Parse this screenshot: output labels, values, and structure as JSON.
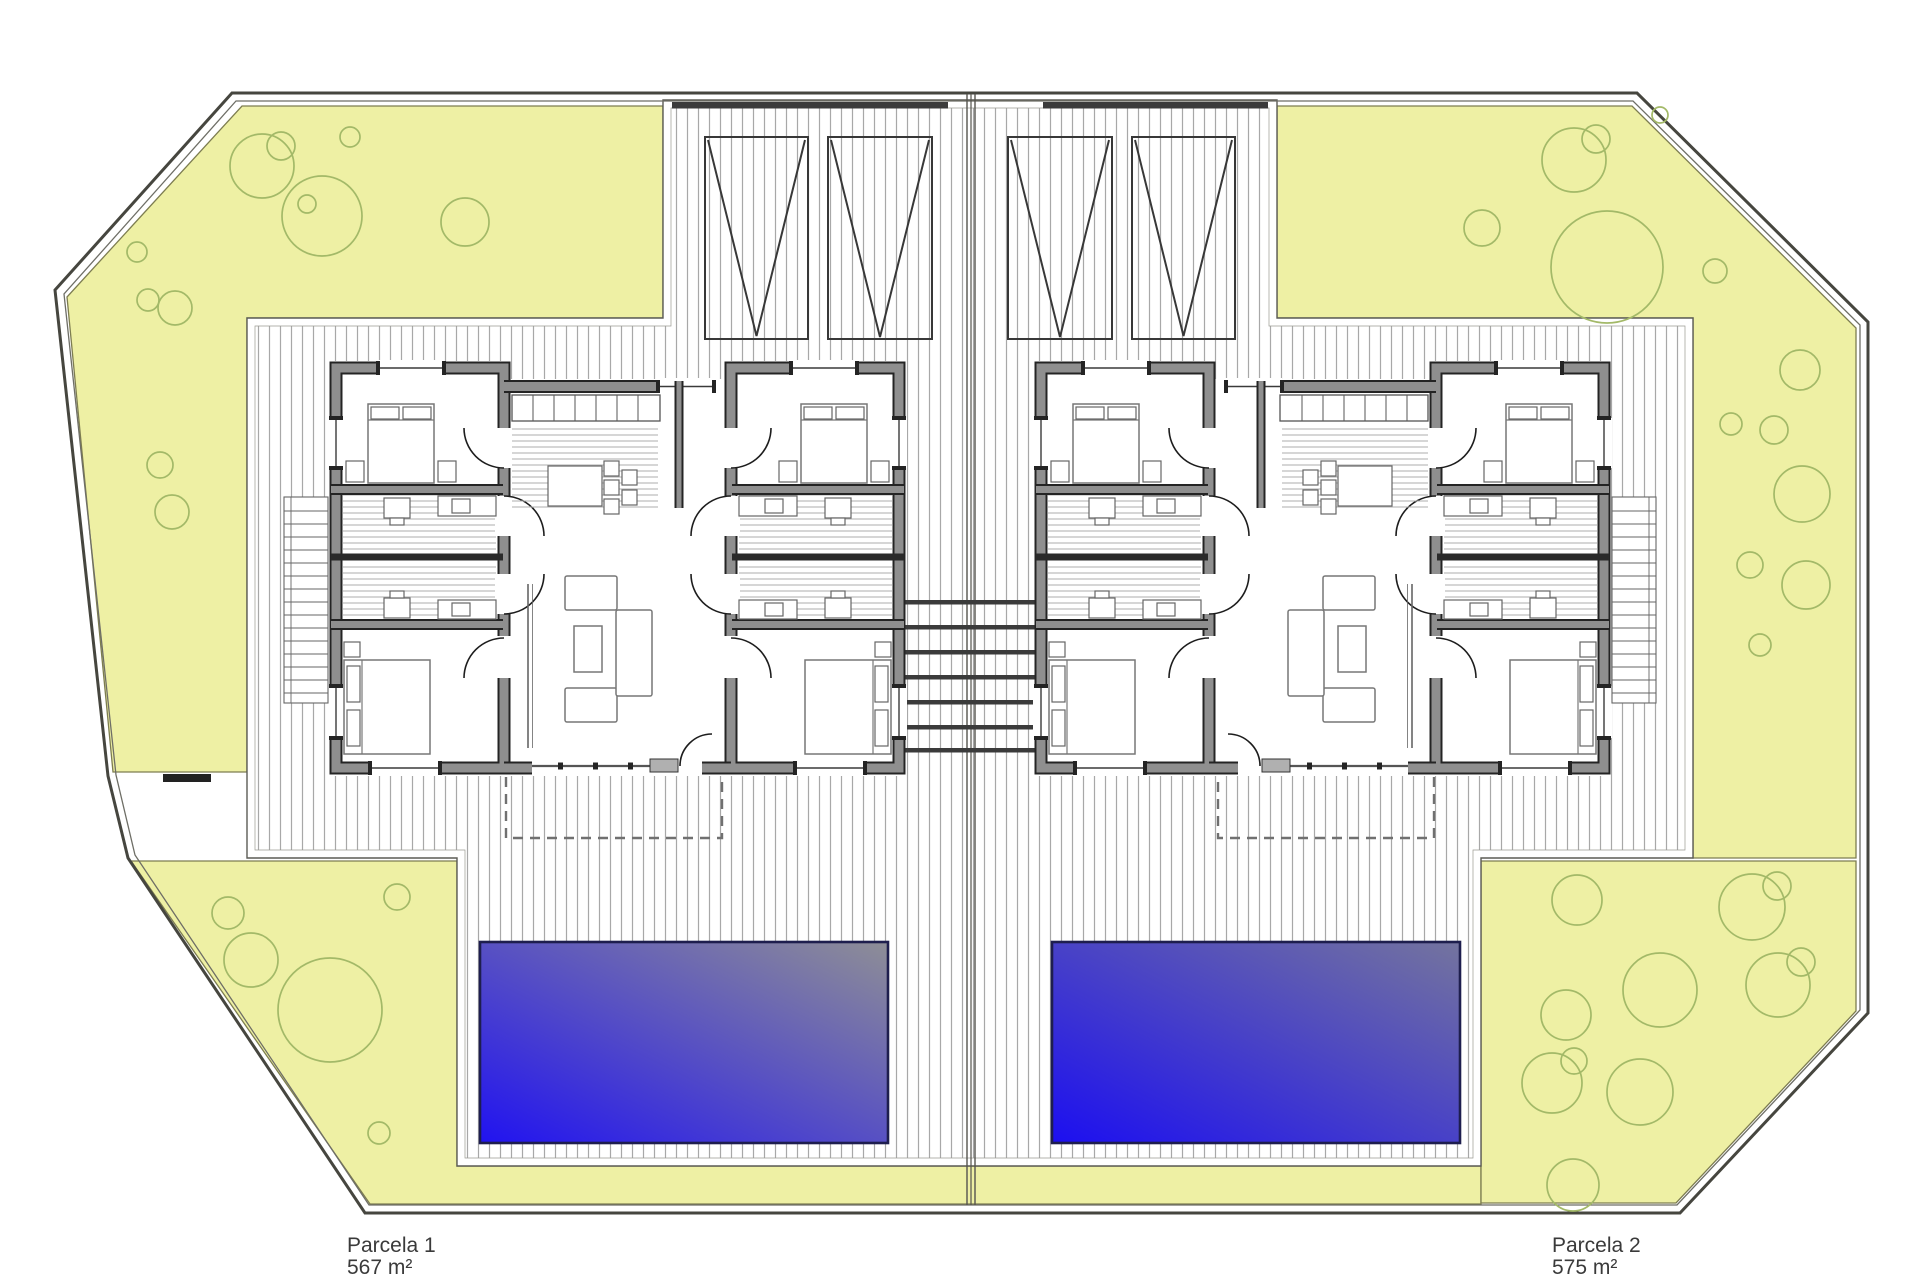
{
  "plan": {
    "parcels": [
      {
        "name": "Parcela 1",
        "area": "567 m²"
      },
      {
        "name": "Parcela 2",
        "area": "575 m²"
      }
    ],
    "colors": {
      "background": "#ffffff",
      "garden_fill": "#eef0a4",
      "garden_stroke": "#7d7d50",
      "tree_stroke": "#a3b968",
      "hatch_line": "#a8a8a8",
      "hatch_border": "#5c5c55",
      "wall_gray": "#8f8f8f",
      "wall_dark": "#242424",
      "boundary": "#46463f",
      "pool_stroke": "#1e1e4e",
      "pool1_gradient_start": "#2113f0",
      "pool1_gradient_end": "#8e8e96",
      "pool2_gradient_start": "#1c0ff0",
      "pool2_gradient_end": "#74749e",
      "steps_bar": "#3b3b3b"
    },
    "features": {
      "houses": 2,
      "pools": 2,
      "carports_per_parcel": 2
    },
    "trees": [
      [
        262,
        166,
        32
      ],
      [
        281,
        146,
        14
      ],
      [
        322,
        216,
        40
      ],
      [
        307,
        204,
        9
      ],
      [
        465,
        222,
        24
      ],
      [
        350,
        137,
        10
      ],
      [
        137,
        252,
        10
      ],
      [
        148,
        300,
        11
      ],
      [
        175,
        308,
        17
      ],
      [
        160,
        465,
        13
      ],
      [
        172,
        512,
        17
      ],
      [
        1574,
        160,
        32
      ],
      [
        1596,
        139,
        14
      ],
      [
        1607,
        267,
        56
      ],
      [
        1482,
        228,
        18
      ],
      [
        1715,
        271,
        12
      ],
      [
        1800,
        370,
        20
      ],
      [
        1660,
        115,
        8
      ],
      [
        1731,
        424,
        11
      ],
      [
        1774,
        430,
        14
      ],
      [
        1802,
        494,
        28
      ],
      [
        1750,
        565,
        13
      ],
      [
        1806,
        585,
        24
      ],
      [
        1760,
        645,
        11
      ],
      [
        228,
        913,
        16
      ],
      [
        251,
        960,
        27
      ],
      [
        397,
        897,
        13
      ],
      [
        330,
        1010,
        52
      ],
      [
        379,
        1133,
        11
      ],
      [
        1577,
        900,
        25
      ],
      [
        1752,
        907,
        33
      ],
      [
        1777,
        886,
        14
      ],
      [
        1660,
        990,
        37
      ],
      [
        1566,
        1015,
        25
      ],
      [
        1778,
        985,
        32
      ],
      [
        1801,
        962,
        14
      ],
      [
        1552,
        1083,
        30
      ],
      [
        1574,
        1061,
        13
      ],
      [
        1640,
        1092,
        33
      ],
      [
        1573,
        1185,
        26
      ]
    ]
  }
}
